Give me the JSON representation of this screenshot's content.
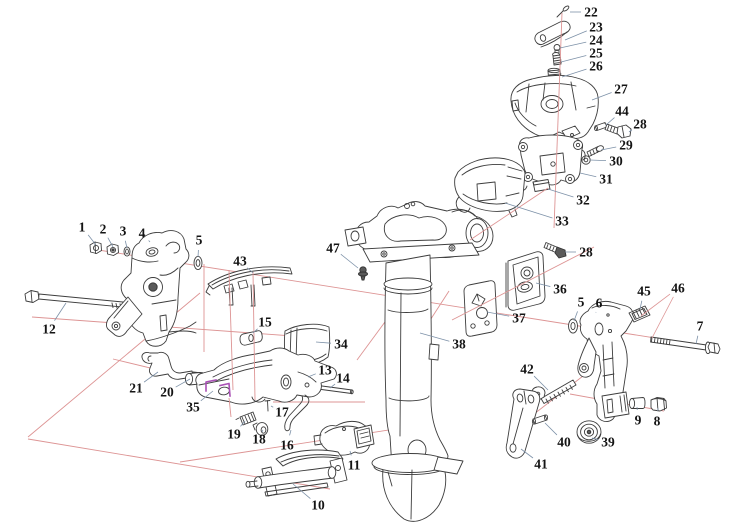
{
  "meta": {
    "width": 742,
    "height": 527,
    "kind": "exploded-parts-diagram"
  },
  "colors": {
    "background": "#ffffff",
    "artwork": "#3d3d3d",
    "axis": "#dd9494",
    "leader": "#7d91a8",
    "highlight": "#a94fb5",
    "label": "#141414"
  },
  "labels": [
    {
      "id": "1",
      "text": "1",
      "x": 82,
      "y": 227,
      "targets": [
        [
          96,
          245
        ]
      ]
    },
    {
      "id": "2",
      "text": "2",
      "x": 103,
      "y": 229,
      "targets": [
        [
          113,
          247
        ]
      ]
    },
    {
      "id": "3",
      "text": "3",
      "x": 123,
      "y": 231,
      "targets": [
        [
          127,
          248
        ]
      ]
    },
    {
      "id": "4",
      "text": "4",
      "x": 142,
      "y": 233,
      "targets": [
        [
          150,
          242
        ]
      ]
    },
    {
      "id": "5l",
      "text": "5",
      "x": 199,
      "y": 240,
      "targets": [
        [
          198,
          257
        ]
      ]
    },
    {
      "id": "12",
      "text": "12",
      "x": 49,
      "y": 329,
      "targets": [
        [
          66,
          303
        ]
      ]
    },
    {
      "id": "43",
      "text": "43",
      "x": 240,
      "y": 261,
      "targets": [
        [
          253,
          273
        ]
      ]
    },
    {
      "id": "15",
      "text": "15",
      "x": 265,
      "y": 322,
      "targets": [
        [
          253,
          333
        ]
      ]
    },
    {
      "id": "34",
      "text": "34",
      "x": 341,
      "y": 344,
      "targets": [
        [
          316,
          342
        ]
      ]
    },
    {
      "id": "13",
      "text": "13",
      "x": 325,
      "y": 370,
      "targets": [
        [
          308,
          377
        ]
      ]
    },
    {
      "id": "14",
      "text": "14",
      "x": 343,
      "y": 378,
      "targets": [
        [
          330,
          388
        ]
      ]
    },
    {
      "id": "21",
      "text": "21",
      "x": 136,
      "y": 388,
      "targets": [
        [
          158,
          372
        ]
      ]
    },
    {
      "id": "20",
      "text": "20",
      "x": 167,
      "y": 392,
      "targets": [
        [
          190,
          379
        ]
      ]
    },
    {
      "id": "35",
      "text": "35",
      "x": 193,
      "y": 407,
      "targets": [
        [
          213,
          391
        ]
      ]
    },
    {
      "id": "19",
      "text": "19",
      "x": 234,
      "y": 434,
      "targets": [
        [
          245,
          421
        ]
      ]
    },
    {
      "id": "18",
      "text": "18",
      "x": 259,
      "y": 439,
      "targets": [
        [
          262,
          432
        ]
      ]
    },
    {
      "id": "17",
      "text": "17",
      "x": 282,
      "y": 412,
      "targets": [
        [
          271,
          406
        ]
      ]
    },
    {
      "id": "16",
      "text": "16",
      "x": 287,
      "y": 445,
      "targets": [
        [
          291,
          430
        ]
      ]
    },
    {
      "id": "10",
      "text": "10",
      "x": 318,
      "y": 505,
      "targets": [
        [
          293,
          484
        ]
      ]
    },
    {
      "id": "11",
      "text": "11",
      "x": 354,
      "y": 465,
      "targets": [
        [
          350,
          451
        ]
      ]
    },
    {
      "id": "47",
      "text": "47",
      "x": 333,
      "y": 248,
      "targets": [
        [
          358,
          268
        ]
      ]
    },
    {
      "id": "38",
      "text": "38",
      "x": 459,
      "y": 344,
      "targets": [
        [
          420,
          333
        ]
      ]
    },
    {
      "id": "37",
      "text": "37",
      "x": 519,
      "y": 318,
      "targets": [
        [
          487,
          312
        ]
      ]
    },
    {
      "id": "36",
      "text": "36",
      "x": 560,
      "y": 289,
      "targets": [
        [
          536,
          283
        ]
      ]
    },
    {
      "id": "28b",
      "text": "28",
      "x": 586,
      "y": 252,
      "targets": [
        [
          565,
          252
        ]
      ]
    },
    {
      "id": "33",
      "text": "33",
      "x": 562,
      "y": 221,
      "targets": [
        [
          505,
          203
        ]
      ]
    },
    {
      "id": "32",
      "text": "32",
      "x": 583,
      "y": 200,
      "targets": [
        [
          548,
          189
        ]
      ]
    },
    {
      "id": "31",
      "text": "31",
      "x": 606,
      "y": 179,
      "targets": [
        [
          580,
          173
        ]
      ]
    },
    {
      "id": "30",
      "text": "30",
      "x": 616,
      "y": 161,
      "targets": [
        [
          590,
          160
        ]
      ]
    },
    {
      "id": "29",
      "text": "29",
      "x": 626,
      "y": 145,
      "targets": [
        [
          601,
          150
        ]
      ]
    },
    {
      "id": "28a",
      "text": "28",
      "x": 640,
      "y": 124,
      "targets": [
        [
          629,
          132
        ]
      ]
    },
    {
      "id": "44",
      "text": "44",
      "x": 622,
      "y": 111,
      "targets": [
        [
          606,
          125
        ]
      ]
    },
    {
      "id": "27",
      "text": "27",
      "x": 621,
      "y": 89,
      "targets": [
        [
          592,
          100
        ]
      ]
    },
    {
      "id": "26",
      "text": "26",
      "x": 596,
      "y": 66,
      "targets": [
        [
          562,
          77
        ]
      ]
    },
    {
      "id": "25",
      "text": "25",
      "x": 596,
      "y": 53,
      "targets": [
        [
          561,
          62
        ]
      ]
    },
    {
      "id": "24",
      "text": "24",
      "x": 596,
      "y": 40,
      "targets": [
        [
          560,
          48
        ]
      ]
    },
    {
      "id": "23",
      "text": "23",
      "x": 596,
      "y": 27,
      "targets": [
        [
          565,
          40
        ]
      ]
    },
    {
      "id": "22",
      "text": "22",
      "x": 591,
      "y": 12,
      "targets": [
        [
          570,
          12
        ]
      ]
    },
    {
      "id": "5r",
      "text": "5",
      "x": 581,
      "y": 302,
      "targets": [
        [
          574,
          321
        ]
      ]
    },
    {
      "id": "6",
      "text": "6",
      "x": 599,
      "y": 303,
      "targets": [
        [
          596,
          312
        ]
      ]
    },
    {
      "id": "45",
      "text": "45",
      "x": 644,
      "y": 291,
      "targets": [
        [
          640,
          309
        ]
      ]
    },
    {
      "id": "46",
      "text": "46",
      "x": 678,
      "y": 288,
      "targets": [
        [
          641,
          316
        ],
        [
          652,
          338
        ]
      ],
      "leader": "axis"
    },
    {
      "id": "7",
      "text": "7",
      "x": 700,
      "y": 326,
      "targets": [
        [
          696,
          344
        ]
      ]
    },
    {
      "id": "42",
      "text": "42",
      "x": 527,
      "y": 369,
      "targets": [
        [
          548,
          390
        ]
      ]
    },
    {
      "id": "40",
      "text": "40",
      "x": 564,
      "y": 442,
      "targets": [
        [
          545,
          423
        ]
      ]
    },
    {
      "id": "39",
      "text": "39",
      "x": 608,
      "y": 442,
      "targets": [
        [
          592,
          438
        ]
      ]
    },
    {
      "id": "41",
      "text": "41",
      "x": 541,
      "y": 464,
      "targets": [
        [
          521,
          449
        ]
      ]
    },
    {
      "id": "9",
      "text": "9",
      "x": 638,
      "y": 420,
      "targets": [
        [
          637,
          407
        ]
      ]
    },
    {
      "id": "8",
      "text": "8",
      "x": 657,
      "y": 421,
      "targets": [
        [
          658,
          408
        ]
      ]
    }
  ]
}
